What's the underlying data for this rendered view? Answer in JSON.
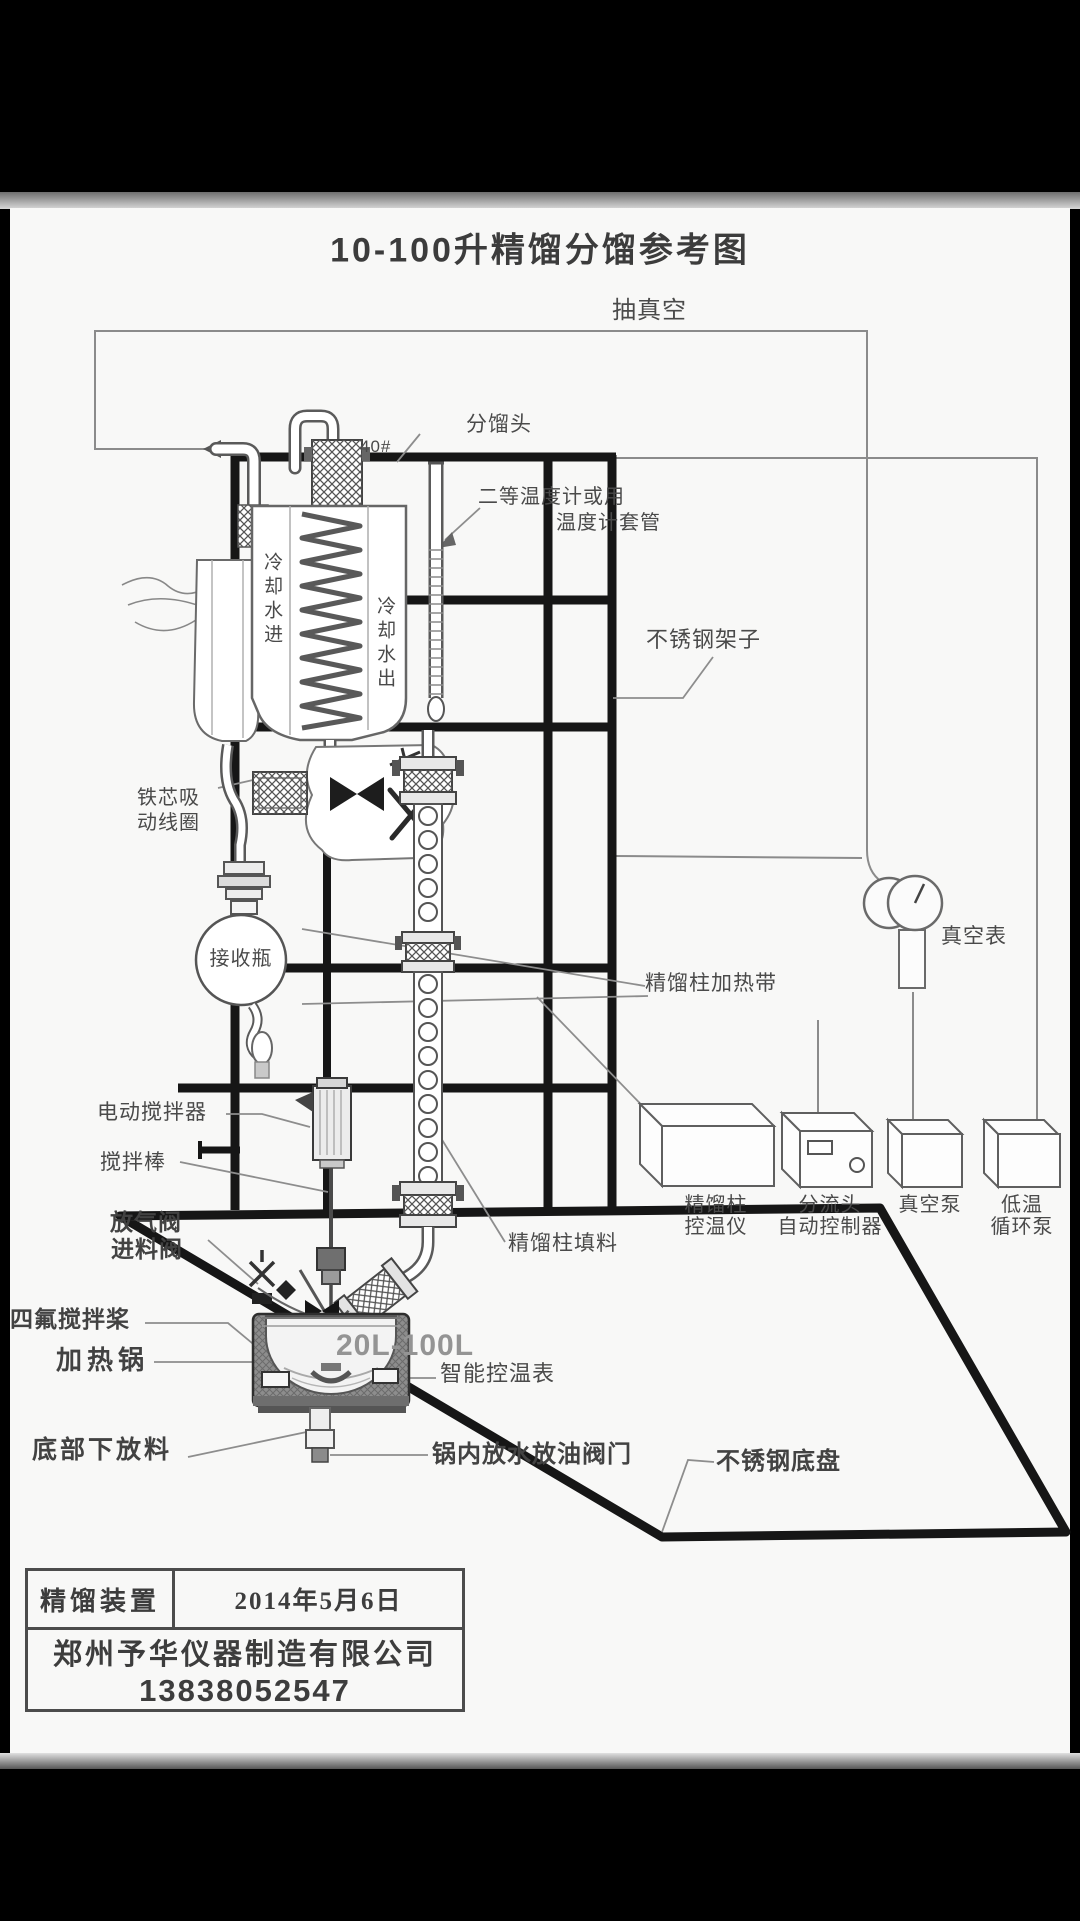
{
  "title": "10-100升精馏分馏参考图",
  "annotations": {
    "vacuum_line": "抽真空",
    "fractionating_head": "分馏头",
    "joint_size": "40#",
    "thermometer_line1": "二等温度计或用",
    "thermometer_line2": "温度计套管",
    "cooling_water_in": "冷却水进",
    "cooling_water_out": "冷却水出",
    "steel_frame": "不锈钢架子",
    "iron_core_line1": "铁芯吸",
    "iron_core_line2": "动线圈",
    "receiver_flask": "接收瓶",
    "vacuum_gauge": "真空表",
    "column_heating_belt": "精馏柱加热带",
    "electric_stirrer": "电动搅拌器",
    "stirring_rod": "搅拌棒",
    "vent_valve": "放气阀",
    "feed_valve": "进料阀",
    "column_packing": "精馏柱填料",
    "ptfe_paddle": "四氟搅拌桨",
    "heating_pot": "加热锅",
    "kettle_capacity": "20L-100L",
    "smart_temp_controller": "智能控温表",
    "bottom_discharge": "底部下放料",
    "pot_drain_valve": "锅内放水放油阀门",
    "steel_base_plate": "不锈钢底盘"
  },
  "devices": [
    {
      "name": "column-temp-controller",
      "lines": [
        "精馏柱",
        "控温仪"
      ]
    },
    {
      "name": "splitter-auto-controller",
      "lines": [
        "分流头",
        "自动控制器"
      ]
    },
    {
      "name": "vacuum-pump",
      "lines": [
        "真空泵"
      ]
    },
    {
      "name": "cryo-circulation-pump",
      "lines": [
        "低温",
        "循环泵"
      ]
    }
  ],
  "footer": {
    "device_name": "精馏装置",
    "date": "2014年5月6日",
    "company": "郑州予华仪器制造有限公司",
    "phone": "13838052547"
  }
}
